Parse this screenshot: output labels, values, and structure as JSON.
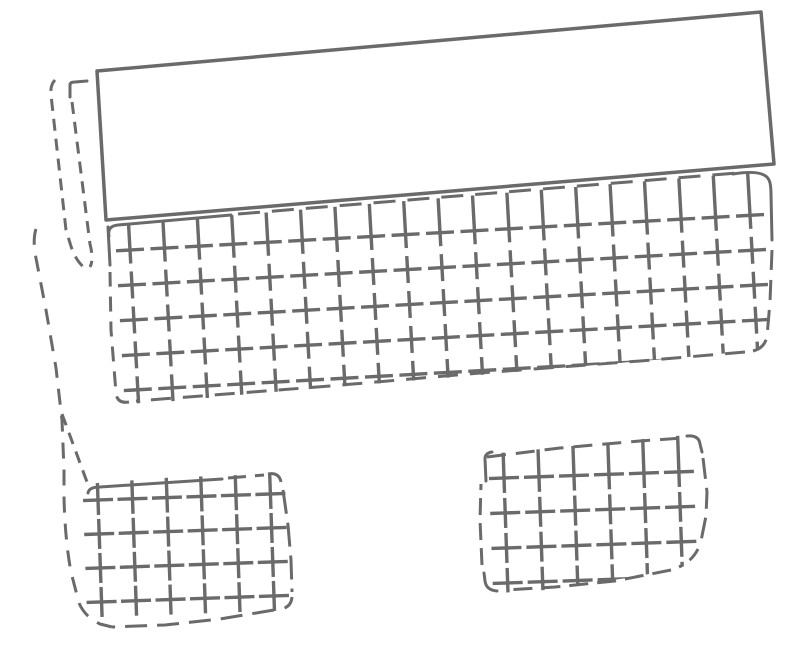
{
  "canvas": {
    "width": 800,
    "height": 646,
    "background": "#ffffff",
    "stroke_color": "#6a6a6a",
    "description": "hand-drawn sketch of panel pieces: solid tilted rectangle, dashed cross-hatched mat, dashed strip, hem curve, two hatched flaps"
  },
  "grids": [
    {
      "name": "main-mat-crosshatch-grid",
      "origin": [
        130,
        250
      ],
      "angle": -3.2,
      "col_step": 34.5,
      "cols": 19,
      "row_step": 35,
      "rows": 5,
      "h_arm": 14,
      "v_arm": 13.5,
      "row0_v_top": -45,
      "width": 3.4,
      "clip": "M102,226 L745,173 L780,180 L778,348 L700,356 L480,375 L250,394 L132,405 L114,406 L102,280 Z"
    },
    {
      "name": "left-flap-lattice-grid",
      "origin": [
        98,
        500
      ],
      "angle": -2,
      "col_step": 34.5,
      "cols": 6,
      "row_step": 34,
      "rows": 4,
      "h_arm": 15,
      "v_arm": 15,
      "row0_v_top": -20,
      "width": 3.4,
      "clip": "M84,484 L270,470 L292,478 L296,599 L283,613 L210,624 L104,630 L80,613 L67,566 L61,505 L60,468 Z"
    },
    {
      "name": "right-flap-lattice-grid",
      "origin": [
        504,
        478
      ],
      "angle": -2,
      "col_step": 35,
      "cols": 6,
      "row_step": 35,
      "rows": 4,
      "h_arm": 15,
      "v_arm": 15,
      "row0_v_top": -38,
      "width": 3.4,
      "clip": "M479,455 L686,435 L707,441 L711,505 L704,549 L688,565 L640,576 L545,590 L484,594 L476,555 L475,490 Z"
    }
  ],
  "shapes": [
    {
      "name": "mat-top-edge-left-solid",
      "d": "M109,236 Q107,226 118,225 L231,215",
      "width": 3
    },
    {
      "name": "mat-top-edge-dashed",
      "d": "M238,214 L737,173",
      "width": 3,
      "dash": "22 12"
    },
    {
      "name": "mat-top-right-corner-solid",
      "d": "M733,174 Q764,169 769,180 Q771,184 771,194 L772,240",
      "width": 3
    },
    {
      "name": "mat-right-edge-dashed",
      "d": "M772,250 L770,302 L767,336 Q765,348 753,351",
      "width": 3,
      "dash": "20 10"
    },
    {
      "name": "mat-bottom-edge-dashed",
      "d": "M745,352 L640,361 L480,373 L330,386 L136,401",
      "width": 3,
      "dash": "20 12"
    },
    {
      "name": "mat-bottom-left-corner-dashed",
      "d": "M129,402 Q117,404 116,393 L111,330 L110,272",
      "width": 3,
      "dash": "15 10"
    },
    {
      "name": "mat-left-edge-solid",
      "d": "M108,227 L110,265",
      "width": 3
    },
    {
      "name": "strip-left-seam-dashed",
      "d": "M55,80 Q50,85 51,95 L66,230 L70,243 Q75,261 86,269",
      "width": 3,
      "dash": "12 8"
    },
    {
      "name": "strip-top-cap-solid",
      "d": "M70,97 L70,85 Q70,82 75,82 L87,81",
      "width": 3
    },
    {
      "name": "strip-right-seam-dashed",
      "d": "M72,102 L90,244 Q94,260 90,267",
      "width": 3,
      "dash": "12 8"
    },
    {
      "name": "hem-curve-dashed",
      "d": "M36,229 Q33,238 35,253 L46,310 L56,368 L62,420 L64,470 L64,497 Q65,540 71,572 L79,603 Q85,617 100,624 L112,627",
      "width": 3,
      "dash": "16 11"
    },
    {
      "name": "crease-diagonal-dashed",
      "d": "M62,414 L87,482",
      "width": 3,
      "dash": "12 8"
    },
    {
      "name": "left-flap-top-edge-solid",
      "d": "M88,493 Q89,487 100,487 L222,479",
      "width": 3
    },
    {
      "name": "left-flap-top-edge-dashed",
      "d": "M228,478 L264,475",
      "width": 3,
      "dash": "18 9"
    },
    {
      "name": "left-flap-top-right-corner-dashed",
      "d": "M268,474 Q279,472 281,482",
      "width": 3,
      "dash": "20 8"
    },
    {
      "name": "left-flap-right-edge-dashed",
      "d": "M283,490 L288,525 L291,560 L292,592",
      "width": 3,
      "dash": "24 9"
    },
    {
      "name": "left-flap-bottom-right-corner-dashed",
      "d": "M292,597 Q291,608 280,609",
      "width": 3,
      "dash": "14 8"
    },
    {
      "name": "left-flap-bottom-edge-dashed",
      "d": "M274,610 L220,619 L165,625 L112,627",
      "width": 3,
      "dash": "22 10"
    },
    {
      "name": "right-flap-top-edge-dashed",
      "d": "M487,457 L560,448 L640,441 L683,438",
      "width": 3,
      "dash": "19 10"
    },
    {
      "name": "right-flap-top-right-corner-solid",
      "d": "M687,436 Q699,435 700,444 L702,452",
      "width": 3
    },
    {
      "name": "right-flap-right-edge-dashed",
      "d": "M703,458 L707,492 L706,516 L701,541",
      "width": 3,
      "dash": "21 9"
    },
    {
      "name": "right-flap-bottom-right-curve-dashed",
      "d": "M698,549 Q692,561 679,567",
      "width": 3,
      "dash": "14 8"
    },
    {
      "name": "right-flap-bottom-edge-dashed",
      "d": "M671,570 L615,581 L555,587 L505,590",
      "width": 3,
      "dash": "19 9"
    },
    {
      "name": "right-flap-bottom-left-corner-solid",
      "d": "M497,591 Q486,590 485,581 L484,573",
      "width": 3
    },
    {
      "name": "right-flap-left-edge-dashed",
      "d": "M482,565 L480,520 L481,484",
      "width": 3,
      "dash": "17 8"
    },
    {
      "name": "right-flap-top-left-corner-solid",
      "d": "M486,481 L485,459 Q485,453 492,452",
      "width": 3
    },
    {
      "name": "top-panel-rectangle",
      "d": "M97,71 L761,12 L774,164 L106,220 Z",
      "width": 3.5,
      "fill": "#ffffff"
    }
  ]
}
